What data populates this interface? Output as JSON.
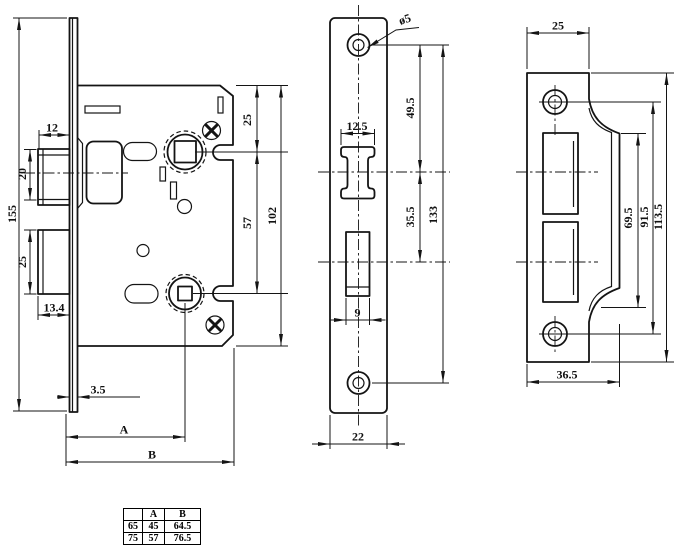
{
  "drawing_title": "mortise lock technical drawing",
  "views": {
    "lock_body": {
      "dims": {
        "latch_protrusion": "12",
        "latch_height": "20",
        "total_height": "155",
        "deadbolt_height": "25",
        "deadbolt_protrusion": "13.4",
        "faceplate_thickness": "3.5",
        "backset_label": "A",
        "case_depth_label": "B",
        "top_to_spindle": "25",
        "spindle_to_turn": "57",
        "case_height": "102"
      }
    },
    "faceplate": {
      "dims": {
        "screw_hole_dia": "ø5",
        "latch_cutout_width": "12.5",
        "screw_to_latch_center": "49.5",
        "latch_to_bolt_center": "35.5",
        "screw_spacing": "133",
        "bolt_cutout_width": "9",
        "plate_width": "22"
      }
    },
    "strike_plate": {
      "dims": {
        "top_width": "25",
        "lip_length": "69.5",
        "screw_spacing": "91.5",
        "plate_height": "113.5",
        "bottom_width": "36.5"
      }
    }
  },
  "size_table": {
    "headers": [
      "",
      "A",
      "B"
    ],
    "rows": [
      [
        "65",
        "45",
        "64.5"
      ],
      [
        "75",
        "57",
        "76.5"
      ]
    ]
  }
}
